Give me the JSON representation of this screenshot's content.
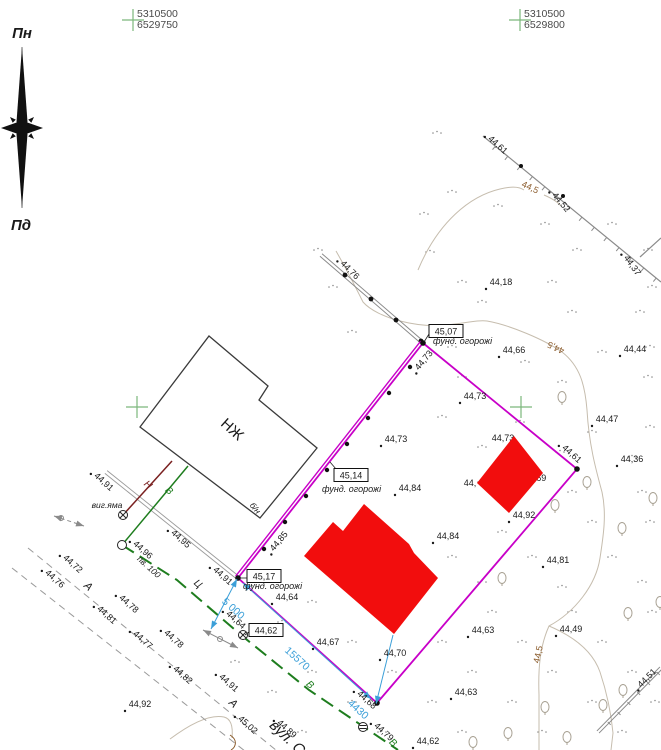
{
  "title": "Топографічний план земельної ділянки",
  "colors": {
    "k": "#1a1a1a",
    "g": "#1e7d1e",
    "n": "#7a2020",
    "c": "#3b9fd8",
    "b": "#8a5a2a",
    "parcel": "#c800c8",
    "red": "#f20d0d",
    "fence": "#8a8a8a",
    "road": "#9a9a9a",
    "contour": "#c6bdae",
    "cross": "#7cb87c",
    "coord": "#4a4a4a"
  },
  "compass": {
    "north_label": "Пн",
    "south_label": "Пд",
    "cx": 22,
    "top": 47,
    "bottom": 208,
    "mid": 128
  },
  "grid_crosses": [
    {
      "x": 133,
      "y": 20,
      "line1": "5310500",
      "line2": "6529750"
    },
    {
      "x": 520,
      "y": 20,
      "line1": "5310500",
      "line2": "6529800"
    },
    {
      "x": 137,
      "y": 407
    },
    {
      "x": 521,
      "y": 407
    }
  ],
  "parcel": {
    "points": [
      [
        423,
        343
      ],
      [
        577,
        469
      ],
      [
        377,
        703
      ],
      [
        238,
        578
      ]
    ],
    "posts": [
      [
        410,
        367
      ],
      [
        389,
        393
      ],
      [
        368,
        418
      ],
      [
        347,
        444
      ],
      [
        327,
        470
      ],
      [
        306,
        496
      ],
      [
        285,
        522
      ],
      [
        264,
        549
      ]
    ]
  },
  "buildings": {
    "house": {
      "points": [
        [
          209,
          336
        ],
        [
          268,
          386
        ],
        [
          259,
          400
        ],
        [
          317,
          448
        ],
        [
          260,
          518
        ],
        [
          140,
          427
        ]
      ],
      "label": {
        "t": "НЖ",
        "x": 229,
        "y": 433,
        "r": 42,
        "s": 15
      }
    },
    "red_main": {
      "points": [
        [
          364,
          504
        ],
        [
          409,
          544
        ],
        [
          414,
          553
        ],
        [
          438,
          578
        ],
        [
          394,
          634
        ],
        [
          304,
          556
        ],
        [
          333,
          522
        ],
        [
          343,
          531
        ]
      ]
    },
    "red_small": {
      "points": [
        [
          514,
          436
        ],
        [
          543,
          473
        ],
        [
          509,
          513
        ],
        [
          477,
          483
        ]
      ]
    }
  },
  "fences": {
    "f1": {
      "p1": [
        321,
        255
      ],
      "p2": [
        423,
        343
      ],
      "posts": [
        [
          345,
          275
        ],
        [
          371,
          299
        ],
        [
          396,
          320
        ],
        [
          421,
          341
        ]
      ]
    },
    "f2": {
      "p1": [
        483,
        136
      ],
      "p2": [
        661,
        282
      ],
      "dots": [
        [
          521,
          166
        ],
        [
          563,
          196
        ]
      ]
    },
    "f3": {
      "p1": [
        640,
        257
      ],
      "p2": [
        661,
        238
      ]
    },
    "f4": {
      "p1": [
        598,
        732
      ],
      "p2": [
        661,
        668
      ]
    },
    "path": {
      "p1": [
        106,
        472
      ],
      "p2": [
        237,
        577
      ]
    }
  },
  "contours": [
    {
      "d": "M336,251 C348,272 356,288 363,302 C377,318 420,330 455,324 C470,322 480,320 487,321 C510,325 545,340 562,352 C580,366 585,385 587,410 C589,445 596,470 602,492 C607,515 603,538 600,558 C596,585 575,612 549,626 C540,646 538,668 539,695 L539,750",
      "c": "contour"
    },
    {
      "d": "M549,626 C575,637 593,652 600,672 C607,693 611,712 613,733 L611,750",
      "c": "contour"
    },
    {
      "d": "M418,270 C438,222 470,196 500,189 C512,186 520,187 524,190",
      "c": "contour"
    },
    {
      "d": "M544,195 C551,198 557,201 561,206",
      "c": "contour"
    },
    {
      "d": "M170,739 C190,724 210,714 224,717 C232,719 233,728 232,738",
      "c": "contour"
    },
    {
      "d": "M230,735 C238,740 236,747 231,750",
      "c": "b"
    }
  ],
  "roads": [
    {
      "pts": [
        [
          28,
          548
        ],
        [
          282,
          755
        ]
      ]
    },
    {
      "pts": [
        [
          12,
          568
        ],
        [
          250,
          755
        ]
      ]
    }
  ],
  "utilities": {
    "sewer": {
      "pts": [
        [
          172,
          461
        ],
        [
          123,
          515
        ]
      ]
    },
    "water_house": {
      "pts": [
        [
          188,
          466
        ],
        [
          122,
          545
        ]
      ]
    },
    "water_main": {
      "pts": [
        [
          122,
          545
        ],
        [
          177,
          580
        ],
        [
          241,
          635
        ],
        [
          309,
          690
        ],
        [
          364,
          727
        ],
        [
          398,
          750
        ]
      ]
    }
  },
  "wells": [
    {
      "x": 123,
      "y": 515,
      "kind": "x"
    },
    {
      "x": 122,
      "y": 545,
      "kind": "o"
    },
    {
      "x": 243,
      "y": 635,
      "kind": "x"
    },
    {
      "x": 363,
      "y": 727,
      "kind": "h"
    }
  ],
  "markers": [
    {
      "x1": 203,
      "y1": 630,
      "x2": 238,
      "y2": 648,
      "circle": [
        220,
        639
      ],
      "dashed": 0
    },
    {
      "x1": 54,
      "y1": 516,
      "x2": 84,
      "y2": 526,
      "circle": [
        61,
        518
      ],
      "dashed": 1
    }
  ],
  "dimensions": [
    {
      "x1": 243,
      "y1": 583,
      "x2": 371,
      "y2": 699,
      "arrows": "both"
    },
    {
      "x1": 393,
      "y1": 635,
      "x2": 376,
      "y2": 704,
      "arrows": "end"
    },
    {
      "x1": 237,
      "y1": 579,
      "x2": 211,
      "y2": 629,
      "arrows": "both"
    }
  ],
  "boxes": [
    {
      "t": "45,07",
      "x": 446,
      "y": 331,
      "sub": "фунд. огорожі",
      "sx": 433,
      "sy": 344,
      "lx1": 429,
      "ly1": 334,
      "lx2": 424,
      "ly2": 342
    },
    {
      "t": "45,14",
      "x": 351,
      "y": 475,
      "sub": "фунд. огорожі",
      "sx": 322,
      "sy": 492,
      "lx1": 336,
      "ly1": 469,
      "lx2": 330,
      "ly2": 462
    },
    {
      "t": "45,17",
      "x": 264,
      "y": 576,
      "sub": "фунд. огорожі",
      "sx": 243,
      "sy": 589,
      "lx1": 247,
      "ly1": 578,
      "lx2": 240,
      "ly2": 578
    },
    {
      "t": "44,62",
      "x": 266,
      "y": 630,
      "sub": "",
      "sx": 0,
      "sy": 0,
      "lx1": 249,
      "ly1": 632,
      "lx2": 245,
      "ly2": 635
    }
  ],
  "labels": [
    {
      "t": "44,61",
      "x": 496,
      "y": 147,
      "r": 42,
      "d": 1
    },
    {
      "t": "44,5",
      "x": 529,
      "y": 190,
      "r": 25,
      "c": "b"
    },
    {
      "t": "44,52",
      "x": 559,
      "y": 204,
      "r": 50,
      "d": 1
    },
    {
      "t": "44,37",
      "x": 630,
      "y": 267,
      "r": 55,
      "d": 1
    },
    {
      "t": "44,76",
      "x": 348,
      "y": 272,
      "r": 45,
      "d": 1
    },
    {
      "t": "44,18",
      "x": 501,
      "y": 285,
      "d": 1
    },
    {
      "t": "44,66",
      "x": 514,
      "y": 353,
      "d": 1
    },
    {
      "t": "44,44",
      "x": 635,
      "y": 352,
      "d": 1
    },
    {
      "t": "44,5",
      "x": 557,
      "y": 345,
      "r": 205,
      "c": "b"
    },
    {
      "t": "44,73",
      "x": 426,
      "y": 362,
      "r": -50,
      "d": 1
    },
    {
      "t": "44,73",
      "x": 475,
      "y": 399,
      "d": 1
    },
    {
      "t": "44,47",
      "x": 607,
      "y": 422,
      "d": 1
    },
    {
      "t": "44,36",
      "x": 632,
      "y": 462,
      "d": 1
    },
    {
      "t": "44,73",
      "x": 396,
      "y": 442,
      "d": 1
    },
    {
      "t": "44,84",
      "x": 410,
      "y": 491,
      "d": 1
    },
    {
      "t": "44,84",
      "x": 448,
      "y": 539,
      "d": 1
    },
    {
      "t": "44,92",
      "x": 524,
      "y": 518,
      "d": 1
    },
    {
      "t": "44,81",
      "x": 558,
      "y": 563,
      "d": 1
    },
    {
      "t": "44,61",
      "x": 570,
      "y": 456,
      "r": 42,
      "d": 1
    },
    {
      "t": "44,85",
      "x": 281,
      "y": 543,
      "r": -50,
      "d": 1
    },
    {
      "t": "44,73",
      "x": 503,
      "y": 441,
      "u": 1
    },
    {
      "t": "44,69",
      "x": 535,
      "y": 481,
      "u": 1
    },
    {
      "t": "44,",
      "x": 470,
      "y": 486
    },
    {
      "t": "44,91",
      "x": 102,
      "y": 484,
      "r": 42,
      "d": 1
    },
    {
      "t": "виг.яма",
      "x": 107,
      "y": 508,
      "s": 8.5,
      "i": 1
    },
    {
      "t": "44,95",
      "x": 179,
      "y": 541,
      "r": 42,
      "d": 1
    },
    {
      "t": "44,96",
      "x": 141,
      "y": 552,
      "r": 42,
      "d": 1
    },
    {
      "t": "пв. 100",
      "x": 147,
      "y": 569,
      "r": 42,
      "s": 8.5,
      "i": 1
    },
    {
      "t": "Н",
      "x": 146,
      "y": 487,
      "r": 42,
      "c": "n",
      "s": 10,
      "i": 1
    },
    {
      "t": "В",
      "x": 167,
      "y": 493,
      "r": 42,
      "c": "g",
      "s": 10,
      "i": 1
    },
    {
      "t": "б/н",
      "x": 253,
      "y": 510,
      "r": 50,
      "s": 8.5,
      "i": 1
    },
    {
      "t": "44,72",
      "x": 71,
      "y": 566,
      "r": 42,
      "d": 1
    },
    {
      "t": "44,76",
      "x": 53,
      "y": 581,
      "r": 42,
      "d": 1
    },
    {
      "t": "А",
      "x": 86,
      "y": 589,
      "r": 42,
      "s": 11,
      "i": 1
    },
    {
      "t": "44,78",
      "x": 127,
      "y": 606,
      "r": 42,
      "d": 1
    },
    {
      "t": "44,81",
      "x": 105,
      "y": 617,
      "r": 42,
      "d": 1
    },
    {
      "t": "44,77",
      "x": 141,
      "y": 642,
      "r": 42,
      "d": 1
    },
    {
      "t": "44,78",
      "x": 172,
      "y": 641,
      "r": 42,
      "d": 1
    },
    {
      "t": "44,82",
      "x": 181,
      "y": 677,
      "r": 42,
      "d": 1
    },
    {
      "t": "44,91",
      "x": 227,
      "y": 685,
      "r": 42,
      "d": 1
    },
    {
      "t": "44,92",
      "x": 140,
      "y": 707,
      "d": 1
    },
    {
      "t": "А",
      "x": 231,
      "y": 706,
      "r": 42,
      "s": 11,
      "i": 1
    },
    {
      "t": "45,02",
      "x": 246,
      "y": 727,
      "r": 42,
      "d": 1
    },
    {
      "t": "44,89",
      "x": 285,
      "y": 731,
      "r": 42,
      "d": 1
    },
    {
      "t": "вул. С",
      "x": 284,
      "y": 741,
      "r": 44,
      "s": 15,
      "i": 1
    },
    {
      "t": "44,91",
      "x": 221,
      "y": 578,
      "r": 42,
      "d": 1
    },
    {
      "t": "Ц",
      "x": 196,
      "y": 586,
      "r": 42,
      "s": 10,
      "i": 1
    },
    {
      "t": "44,64",
      "x": 287,
      "y": 600,
      "d": 1
    },
    {
      "t": "44,64",
      "x": 234,
      "y": 622,
      "r": 42,
      "d": 1
    },
    {
      "t": "44,67",
      "x": 328,
      "y": 645,
      "d": 1
    },
    {
      "t": "44,70",
      "x": 395,
      "y": 656,
      "d": 1
    },
    {
      "t": "44,68",
      "x": 365,
      "y": 702,
      "r": 42,
      "d": 1
    },
    {
      "t": "44,79",
      "x": 382,
      "y": 734,
      "r": 42,
      "d": 1
    },
    {
      "t": "В",
      "x": 391,
      "y": 745,
      "r": 42,
      "c": "g",
      "s": 10,
      "i": 1
    },
    {
      "t": "44,62",
      "x": 428,
      "y": 744,
      "d": 1
    },
    {
      "t": "44,63",
      "x": 483,
      "y": 633,
      "d": 1
    },
    {
      "t": "44,63",
      "x": 466,
      "y": 695,
      "d": 1
    },
    {
      "t": "44,49",
      "x": 571,
      "y": 632,
      "d": 1
    },
    {
      "t": "44,5",
      "x": 541,
      "y": 655,
      "r": -78,
      "c": "b"
    },
    {
      "t": "44,51",
      "x": 649,
      "y": 680,
      "r": -45,
      "d": 1
    },
    {
      "t": "В",
      "x": 308,
      "y": 687,
      "r": 42,
      "c": "g",
      "s": 10,
      "i": 1
    },
    {
      "t": "15570",
      "x": 295,
      "y": 661,
      "r": 42,
      "c": "c",
      "s": 10.5
    },
    {
      "t": "4430",
      "x": 356,
      "y": 712,
      "r": 42,
      "c": "c",
      "s": 10.5
    },
    {
      "t": "5 000",
      "x": 231,
      "y": 611,
      "r": 42,
      "c": "c",
      "s": 10.5
    }
  ],
  "trees": [
    [
      562,
      397
    ],
    [
      555,
      505
    ],
    [
      587,
      482
    ],
    [
      622,
      528
    ],
    [
      653,
      498
    ],
    [
      502,
      578
    ],
    [
      628,
      613
    ],
    [
      660,
      602
    ],
    [
      545,
      707
    ],
    [
      603,
      705
    ],
    [
      623,
      690
    ],
    [
      508,
      733
    ],
    [
      567,
      737
    ],
    [
      473,
      742
    ]
  ],
  "grass": [
    [
      437,
      133
    ],
    [
      452,
      192
    ],
    [
      424,
      214
    ],
    [
      498,
      206
    ],
    [
      545,
      224
    ],
    [
      612,
      224
    ],
    [
      430,
      252
    ],
    [
      577,
      250
    ],
    [
      648,
      250
    ],
    [
      462,
      282
    ],
    [
      552,
      282
    ],
    [
      652,
      287
    ],
    [
      333,
      287
    ],
    [
      482,
      302
    ],
    [
      572,
      312
    ],
    [
      640,
      312
    ],
    [
      352,
      332
    ],
    [
      452,
      347
    ],
    [
      525,
      362
    ],
    [
      602,
      352
    ],
    [
      650,
      347
    ],
    [
      462,
      377
    ],
    [
      562,
      382
    ],
    [
      648,
      377
    ],
    [
      442,
      417
    ],
    [
      520,
      422
    ],
    [
      592,
      432
    ],
    [
      650,
      427
    ],
    [
      482,
      447
    ],
    [
      560,
      452
    ],
    [
      632,
      457
    ],
    [
      482,
      482
    ],
    [
      572,
      492
    ],
    [
      642,
      492
    ],
    [
      502,
      532
    ],
    [
      592,
      522
    ],
    [
      650,
      522
    ],
    [
      452,
      557
    ],
    [
      532,
      557
    ],
    [
      612,
      557
    ],
    [
      482,
      582
    ],
    [
      562,
      587
    ],
    [
      642,
      582
    ],
    [
      312,
      602
    ],
    [
      402,
      612
    ],
    [
      492,
      612
    ],
    [
      572,
      612
    ],
    [
      652,
      612
    ],
    [
      352,
      642
    ],
    [
      442,
      642
    ],
    [
      522,
      642
    ],
    [
      602,
      642
    ],
    [
      312,
      672
    ],
    [
      392,
      672
    ],
    [
      472,
      672
    ],
    [
      552,
      672
    ],
    [
      632,
      672
    ],
    [
      352,
      702
    ],
    [
      432,
      702
    ],
    [
      512,
      702
    ],
    [
      592,
      702
    ],
    [
      655,
      702
    ],
    [
      302,
      732
    ],
    [
      382,
      732
    ],
    [
      462,
      732
    ],
    [
      542,
      732
    ],
    [
      622,
      732
    ],
    [
      252,
      587
    ],
    [
      282,
      622
    ],
    [
      235,
      662
    ],
    [
      272,
      692
    ],
    [
      318,
      250
    ]
  ]
}
